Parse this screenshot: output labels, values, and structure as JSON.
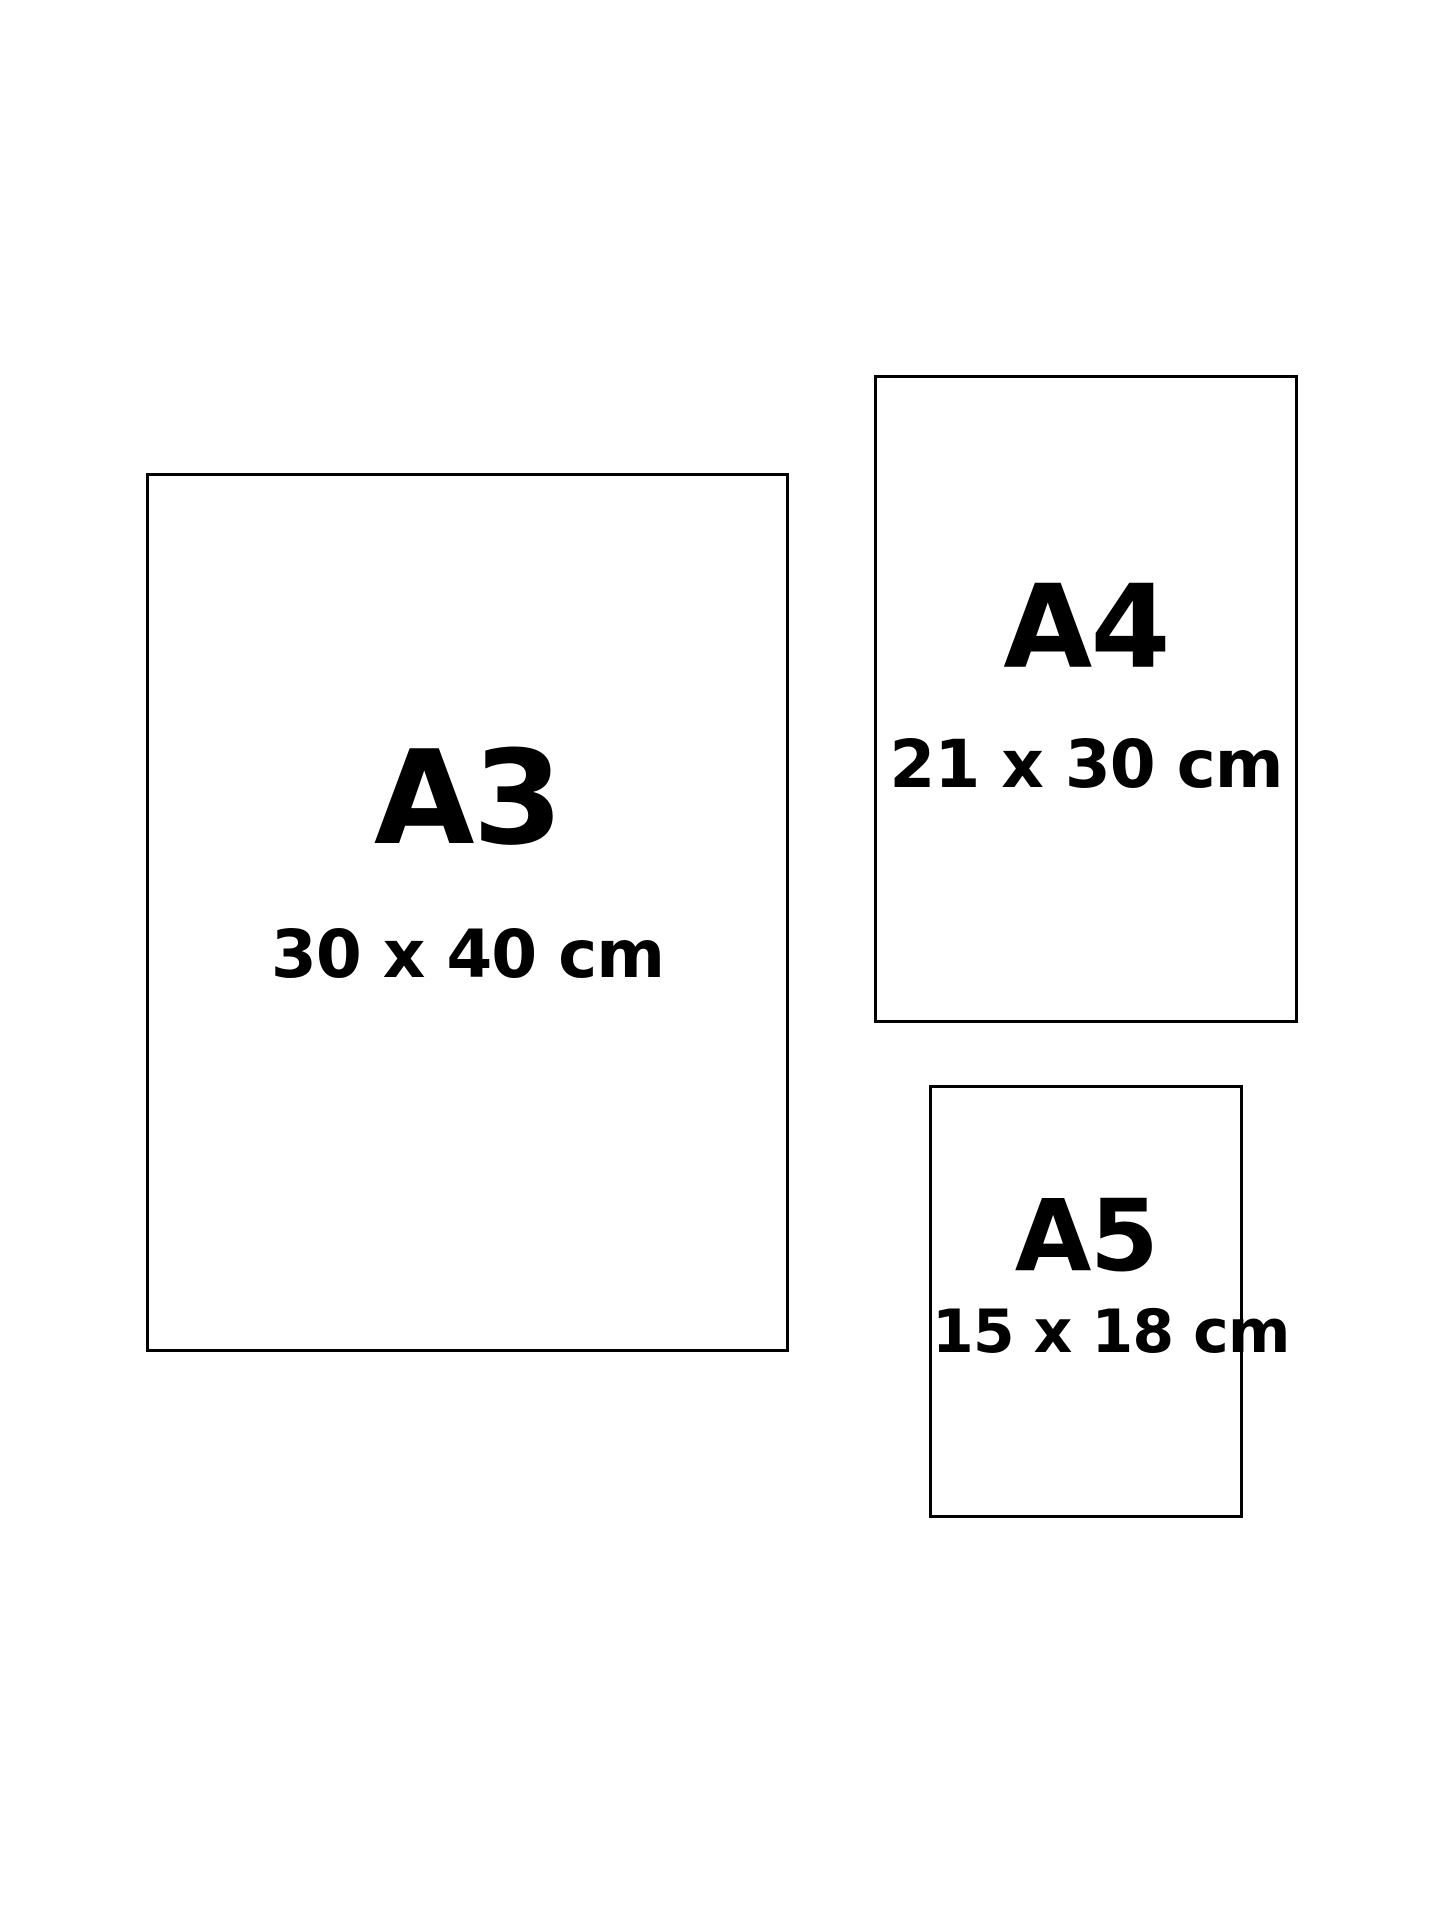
{
  "chart_title": "",
  "papers": [
    {
      "id": "a3",
      "label": "A3",
      "dimensions": "30 x 40 cm"
    },
    {
      "id": "a4",
      "label": "A4",
      "dimensions": "21 x 30 cm"
    },
    {
      "id": "a5",
      "label": "A5",
      "dimensions": "15 x 18 cm"
    }
  ],
  "colors": {
    "background": "#ffffff",
    "outline": "#000000",
    "text": "#000000"
  }
}
